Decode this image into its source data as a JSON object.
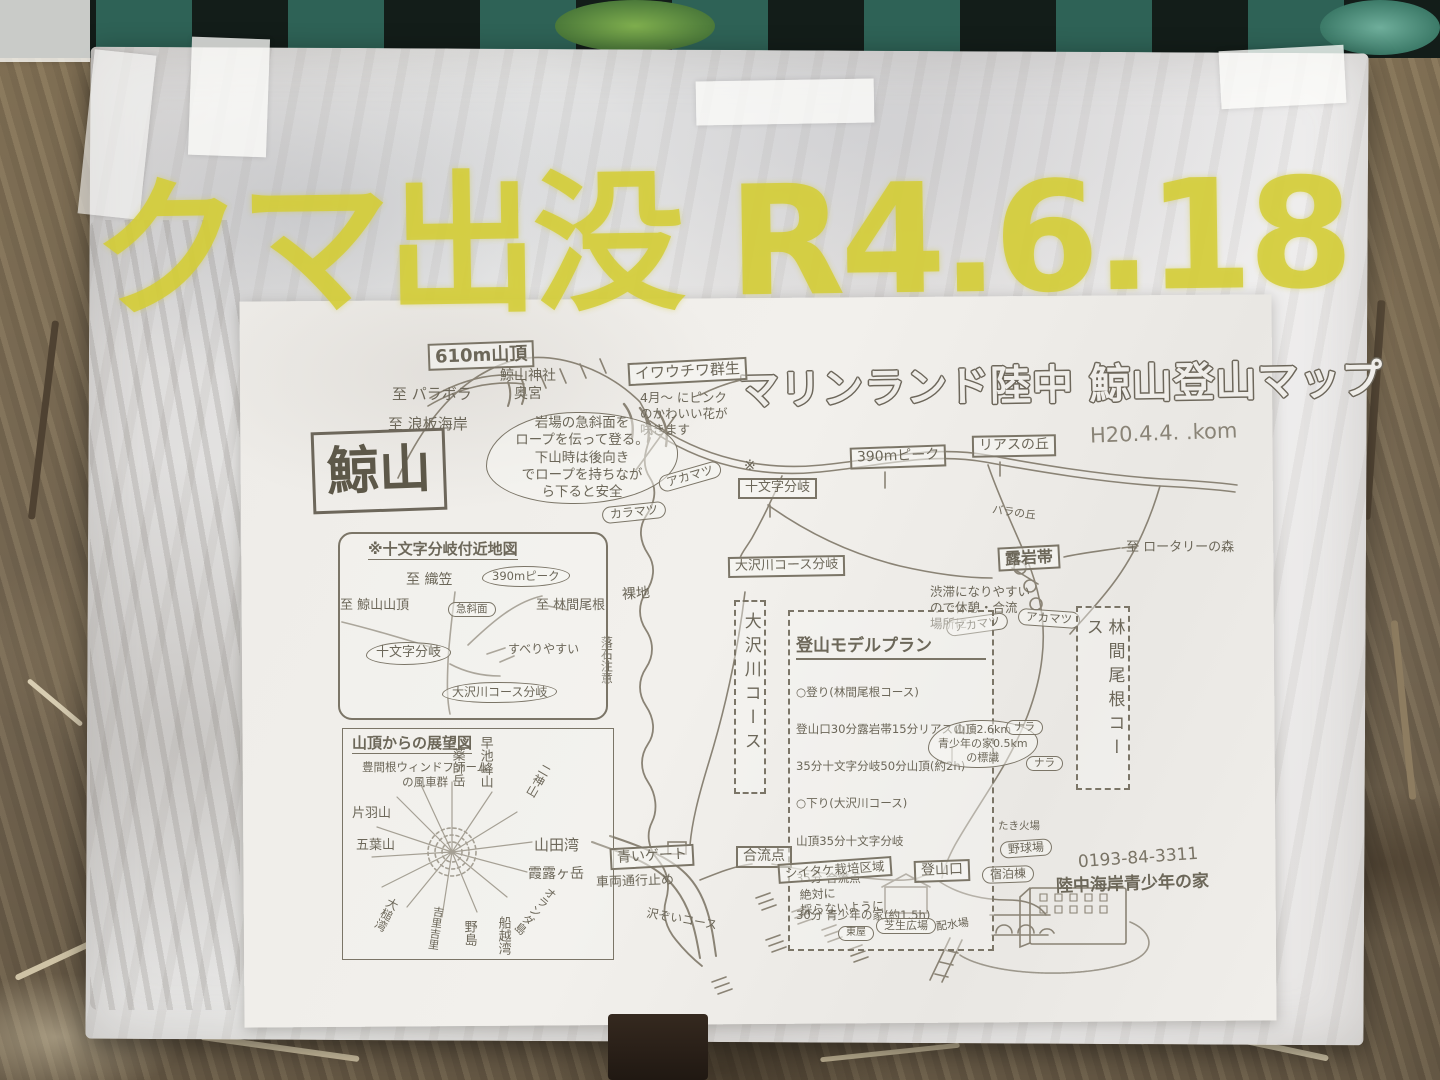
{
  "colors": {
    "warning_yellow": "#d3cd36",
    "board_teal": "#2e6256",
    "ink": "#6c6759",
    "paper": "#efede9"
  },
  "overlay": {
    "warning": "クマ出没 R4.6.18"
  },
  "sign": {
    "title": "マリンランド陸中 鯨山登山マップ",
    "date": "H20.4.4. .kom"
  },
  "labels": {
    "summit610": "610m山頂",
    "toParabola": "至 パラボラ",
    "toNamiita": "至 浪板海岸",
    "shrine": "鯨山神社\n奥宮",
    "kujirayama": "鯨山",
    "iwauchiwaTitle": "イワウチワ群生",
    "iwauchiwaBody": "4月〜 にピンク\nのかわいい花が\n咲きます",
    "ropeNote": "岩場の急斜面を\nロープを伝って登る。\n下山時は後向き\nでロープを持ちなが\nら下ると安全",
    "karamatsu": "カラマツ",
    "akamatsuTop": "アカマツ",
    "kome": "※",
    "jujimonji": "十文字分岐",
    "peak390": "390mピーク",
    "riasHill": "リアスの丘",
    "baranooka": "バラの丘",
    "toRotary": "至 ロータリーの森",
    "osawaBunki": "大沢川コース分岐",
    "bare": "裸地",
    "roiwaTitle": "露岩帯",
    "roiwaNote": "渋滞になりやすい\nので休憩・合流\n場所に",
    "akamatsuL": "アカマツ",
    "akamatsuR": "アカマツ",
    "rinkanCourse": "林間尾根コース",
    "osawaCourse": "大沢川コース",
    "signpostNote": "山頂2.6km\n青少年の家0.5km\nの標識",
    "nara1": "ナラ",
    "nara2": "ナラ",
    "rakuseki": "落石注意",
    "blueGate": "青いゲート",
    "roadClosed": "車両通行止め",
    "sawazoi": "沢ぞいコース",
    "goryuten": "合流点",
    "shiitakeTitle": "シイタケ栽培区域",
    "shiitakeNote": "絶対に\n採らないように",
    "tozanguchi": "登山口",
    "takibiba": "たき火場",
    "yakyujo": "野球場",
    "shukuhaku": "宿泊棟",
    "phone": "0193-84-3311",
    "youthHouse": "陸中海岸青少年の家",
    "haisui": "配水場",
    "hiroba": "芝生広場",
    "azumaya": "東屋"
  },
  "plan": {
    "title": "登山モデルプラン",
    "lines": [
      "○登り(林間尾根コース)",
      "登山口30分露岩帯15分リアスの丘",
      "35分十文字分岐50分山頂(約2h)",
      "○下り(大沢川コース)",
      "山頂35分十文字分岐",
      "35分 合流点",
      "30分 青少年の家(約1.5h)"
    ]
  },
  "kinmap": {
    "title": "※十文字分岐付近地図",
    "toOrikasa": "至 織笠",
    "peak390": "390mピーク",
    "toSummit": "至 鯨山山頂",
    "kyushamen": "急斜面",
    "toRinkan": "至 林間尾根",
    "jujimonji": "十文字分岐",
    "suberi": "すべりやすい",
    "osawaBunki": "大沢川コース分岐"
  },
  "tenbo": {
    "title": "山頂からの展望図",
    "windfarm": "豊間根ウィンドファーム\nの風車群",
    "yakushidake": "薬師岳",
    "hayachine": "早池峰山",
    "futakami": "二神山",
    "katabasan": "片羽山",
    "goyosan": "五葉山",
    "yamadawan": "山田湾",
    "karogatake": "霞露ヶ岳",
    "oranda": "オランダ島",
    "funakoshi": "船越湾",
    "nojima": "野島",
    "kirikiri": "吉里吉里",
    "otsuchi": "大槌湾"
  }
}
